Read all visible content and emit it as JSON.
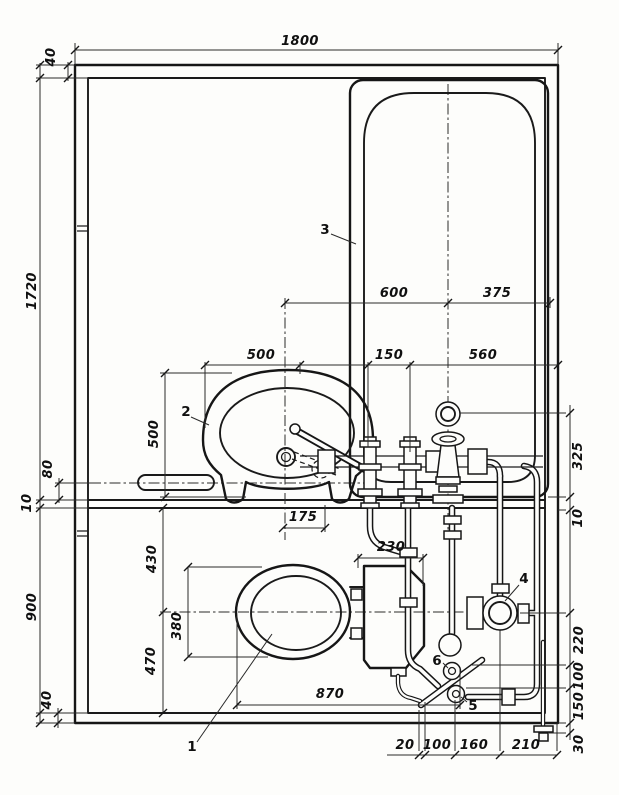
{
  "dims": {
    "width_overall": "1800",
    "wall_top": "40",
    "bath_room_depth": "1720",
    "rail_offset": "80",
    "partition_thickness": "10",
    "wc_depth": "900",
    "wall_bottom": "40",
    "basin_cl_to_tub_cl": "600",
    "tub_cl_to_wall": "375",
    "basin_width": "500",
    "stem_gap": "150",
    "tub_width": "560",
    "basin_depth": "500",
    "mixer_offset": "325",
    "gap_right": "10",
    "cl_offset": "175",
    "wc_front": "430",
    "bowl_width": "380",
    "wc_back": "470",
    "tank_width": "230",
    "bowl_offset": "870",
    "right_220": "220",
    "right_100": "100",
    "right_150": "150",
    "right_30": "30",
    "bottom_20": "20",
    "bottom_100": "100",
    "bottom_160": "160",
    "bottom_210": "210"
  },
  "labels": {
    "toilet": "1",
    "washbasin": "2",
    "bathtub": "3",
    "drain": "4",
    "valve_5": "5",
    "valve_6": "6"
  }
}
